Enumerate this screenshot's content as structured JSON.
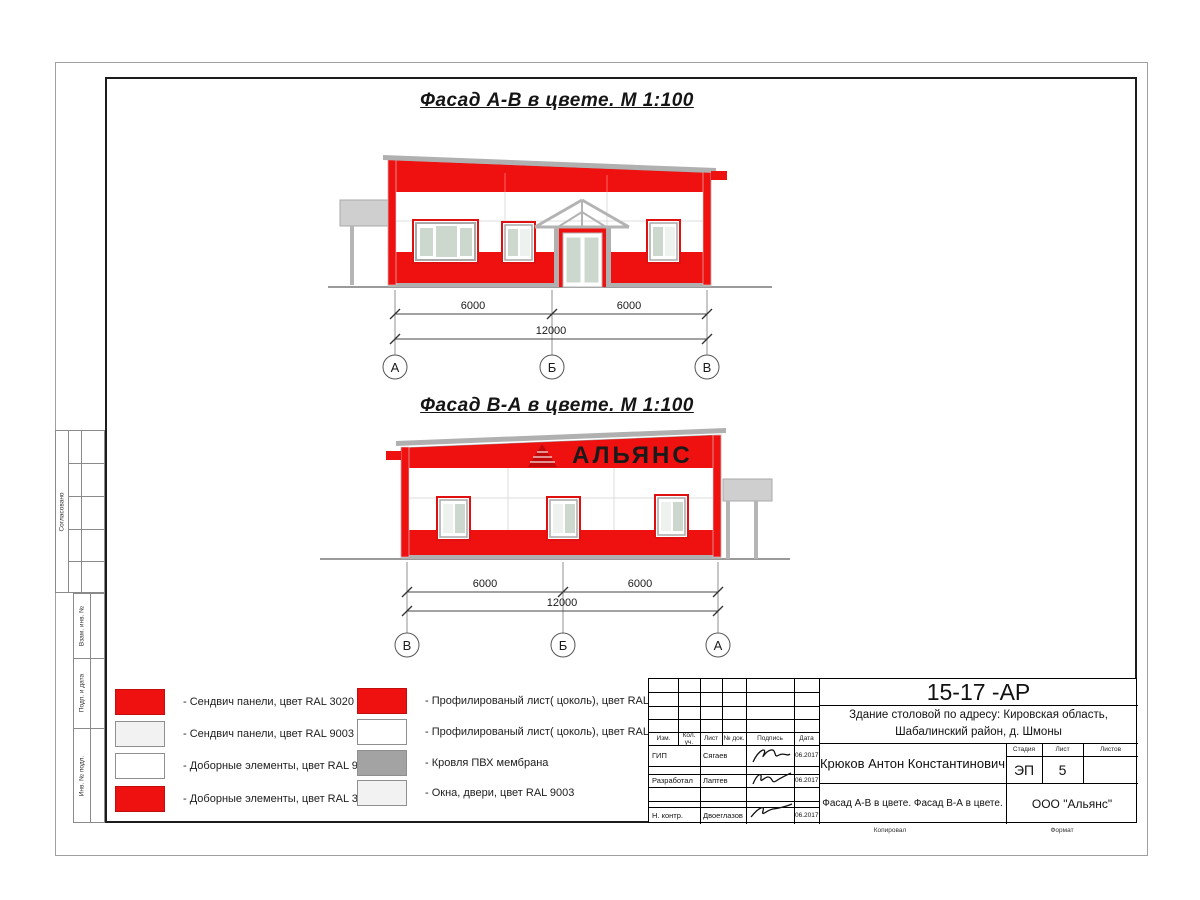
{
  "sheet": {
    "title_facade_ab": "Фасад А-В в цвете.  М 1:100",
    "title_facade_ba": "Фасад В-А в цвете.  М 1:100",
    "watermark": "АЛЬЯНС"
  },
  "colors": {
    "panel_red_ral3020": "#ef1010",
    "panel_white_ral9003": "#f2f2f2",
    "roof_membrane_gray": "#a3a3a3",
    "glass": "#ccd8cd"
  },
  "elev1": {
    "dim_left": "6000",
    "dim_right": "6000",
    "dim_total": "12000",
    "axis_left": "А",
    "axis_mid": "Б",
    "axis_right": "В"
  },
  "elev2": {
    "dim_left": "6000",
    "dim_right": "6000",
    "dim_total": "12000",
    "axis_left": "В",
    "axis_mid": "Б",
    "axis_right": "А"
  },
  "legend": {
    "left": [
      {
        "label": "- Сендвич панели, цвет RAL 3020",
        "color": "#ef1010"
      },
      {
        "label": "- Сендвич панели, цвет RAL 9003",
        "color": "#f2f2f2"
      },
      {
        "label": "- Доборные элементы, цвет RAL 9003",
        "color": "#ffffff"
      },
      {
        "label": "- Доборные элементы, цвет RAL 3020",
        "color": "#ef1010"
      }
    ],
    "right": [
      {
        "label": "- Профилированый лист( цоколь), цвет RAL 3020",
        "color": "#ef1010"
      },
      {
        "label": "- Профилированый лист( цоколь), цвет RAL 9003",
        "color": "#ffffff"
      },
      {
        "label": "- Кровля ПВХ мембрана",
        "color": "#a3a3a3"
      },
      {
        "label": "- Окна, двери, цвет RAL 9003",
        "color": "#f2f2f2"
      }
    ]
  },
  "titleblock": {
    "doc_code": "15-17 -АР",
    "object_line1": "Здание столовой по адресу: Кировская область,",
    "object_line2": "Шабалинский район, д. Шмоны",
    "author_full": "Крюков Антон Константинович",
    "col_izm": "Изм.",
    "col_kol": "Кол. уч.",
    "col_list": "Лист",
    "col_ndok": "№ док.",
    "col_podpis": "Подпись",
    "col_data": "Дата",
    "stage_label": "Стадия",
    "list_label": "Лист",
    "listov_label": "Листов",
    "stage": "ЭП",
    "sheet_no": "5",
    "sheets_total": "",
    "row_gip_role": "ГИП",
    "row_gip_name": "Сягаев",
    "row_gip_date": "06.2017",
    "row_dev_role": "Разработал",
    "row_dev_name": "Лаптев",
    "row_dev_date": "06.2017",
    "row_ncontr_role": "Н. контр.",
    "row_ncontr_name": "Двоеглазов",
    "row_ncontr_date": "06.2017",
    "sheet_name": "Фасад А-В в цвете. Фасад В-А в цвете.",
    "company": "ООО \"Альянс\""
  },
  "side_labels": {
    "approved": "Согласовано",
    "strip1": "Взам. инв. №",
    "strip2": "Подп. и дата",
    "strip3": "Инв. № подл."
  },
  "footer": {
    "copied": "Копировал",
    "format": "Формат"
  }
}
